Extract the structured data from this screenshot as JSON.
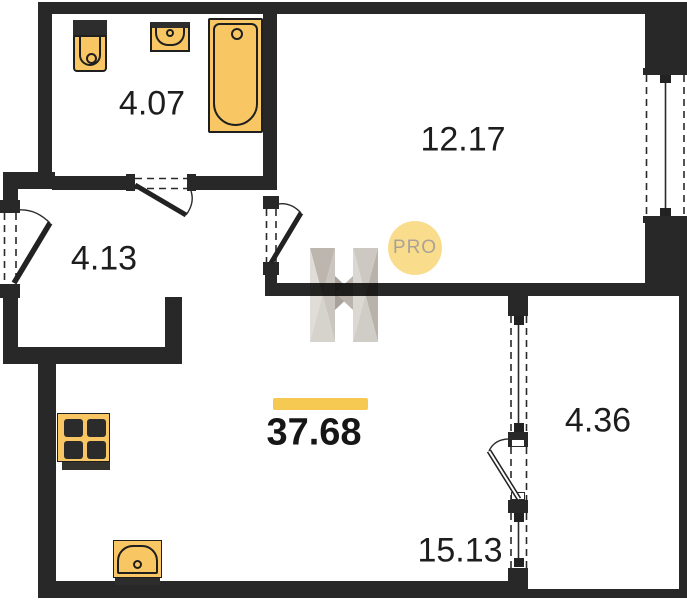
{
  "plan": {
    "type": "apartment-floor-plan",
    "total": {
      "area": "37.68"
    },
    "rooms": [
      {
        "id": "bathroom",
        "area": "4.07"
      },
      {
        "id": "bedroom",
        "area": "12.17"
      },
      {
        "id": "hallway",
        "area": "4.13"
      },
      {
        "id": "balcony",
        "area": "4.36"
      },
      {
        "id": "living-kitchen",
        "area": "15.13"
      }
    ],
    "fixtures": [
      "toilet",
      "bathroom-sink",
      "bathtub",
      "stove-4-burner",
      "kitchen-sink"
    ],
    "watermark": {
      "letter": "H",
      "badge": "PRO"
    },
    "colors": {
      "wall": "#282828",
      "fixture_fill": "#f8c763",
      "accent_bar": "#f6ca52",
      "badge_fill": "#f9dd8d",
      "badge_text": "#a9a296",
      "label_text": "#1d1d1d"
    }
  }
}
